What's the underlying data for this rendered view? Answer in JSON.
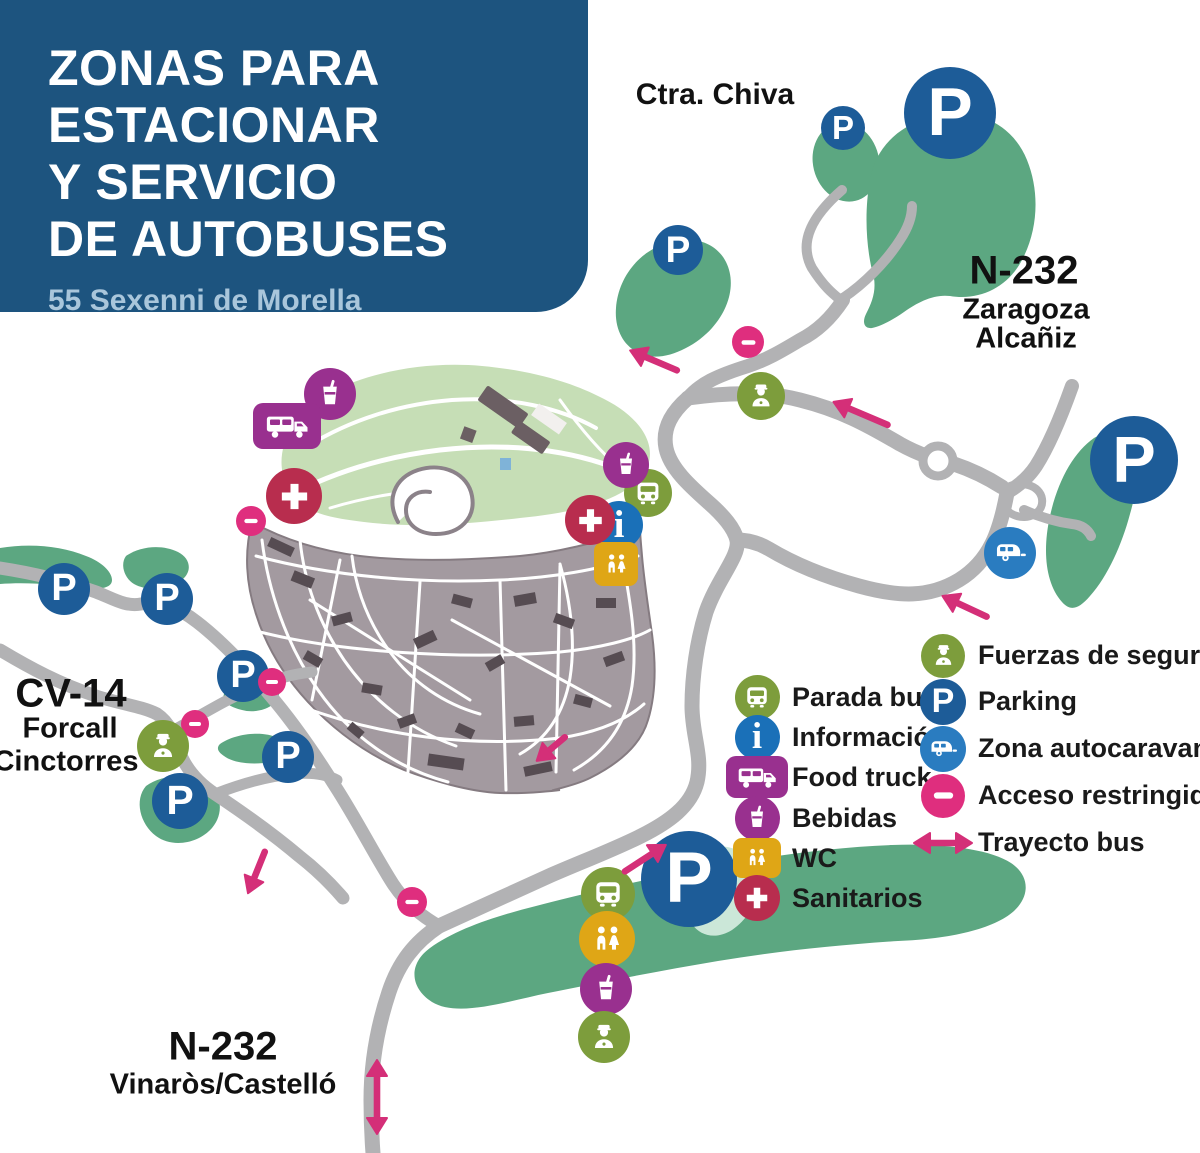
{
  "header": {
    "title_lines": [
      "ZONAS PARA",
      "ESTACIONAR",
      "Y SERVICIO",
      "DE AUTOBUSES"
    ],
    "subtitle": "55 Sexenni de Morella",
    "bg_color": "#1d547f",
    "subtitle_color": "#a9c6db"
  },
  "road_labels": [
    {
      "text": "Ctra. Chiva",
      "x": 715,
      "y": 95,
      "size": 30
    },
    {
      "text": "N-232",
      "x": 1024,
      "y": 271,
      "size": 40
    },
    {
      "text": "Zaragoza",
      "x": 1026,
      "y": 310,
      "size": 29
    },
    {
      "text": "Alcañiz",
      "x": 1026,
      "y": 339,
      "size": 29
    },
    {
      "text": "CV-14",
      "x": 71,
      "y": 694,
      "size": 40
    },
    {
      "text": "Forcall",
      "x": 70,
      "y": 729,
      "size": 29
    },
    {
      "text": "Cinctorres",
      "x": 66,
      "y": 762,
      "size": 29
    },
    {
      "text": "N-232",
      "x": 223,
      "y": 1047,
      "size": 40
    },
    {
      "text": "Vinaròs/Castelló",
      "x": 223,
      "y": 1085,
      "size": 29
    }
  ],
  "legend": {
    "columns": [
      {
        "x": 731,
        "y": 697,
        "row_h": 40.2,
        "items": [
          {
            "icon": "bus",
            "label": "Parada bus",
            "d": 45
          },
          {
            "icon": "info",
            "label": "Información",
            "d": 45
          },
          {
            "icon": "foodtruck",
            "label": "Food truck",
            "w": 62,
            "h": 42
          },
          {
            "icon": "bebidas",
            "label": "Bebidas",
            "d": 45
          },
          {
            "icon": "wc",
            "shape": "square",
            "label": "WC",
            "w": 48,
            "h": 40
          },
          {
            "icon": "sanitarios",
            "label": "Sanitarios",
            "d": 46
          }
        ]
      },
      {
        "x": 917,
        "y": 655,
        "row_h": 46.8,
        "items": [
          {
            "icon": "fuerzas",
            "label": "Fuerzas de seguridad",
            "d": 44
          },
          {
            "icon": "parking",
            "label": "Parking",
            "d": 46
          },
          {
            "icon": "caravan",
            "label": "Zona autocaravanas",
            "d": 46
          },
          {
            "icon": "noentry",
            "label": "Acceso restringido",
            "d": 44
          },
          {
            "icon": "arrow2",
            "label": "Trayecto bus",
            "len": 62
          }
        ]
      }
    ]
  },
  "map": {
    "colors": {
      "bus": "#7d9d3c",
      "fuerzas": "#7d9d3c",
      "info": "#1a70b8",
      "parking": "#1d5c98",
      "caravan": "#2a7cc0",
      "bebidas": "#99308f",
      "foodtruck": "#99308f",
      "wc": "#dfa616",
      "sanitarios": "#b82d4e",
      "noentry": "#df2e7e",
      "arrow": "#d42f78",
      "arrow2": "#d42f78",
      "road": "#b2b2b4",
      "zone_green": "#5ca781",
      "hill_green": "#c6deb6",
      "town_gray": "#a39aa0"
    },
    "markers": [
      {
        "type": "parking",
        "x": 843,
        "y": 128,
        "d": 44
      },
      {
        "type": "parking",
        "x": 678,
        "y": 250,
        "d": 50
      },
      {
        "type": "parking",
        "x": 950,
        "y": 113,
        "d": 92
      },
      {
        "type": "parking",
        "x": 1134,
        "y": 460,
        "d": 88
      },
      {
        "type": "parking",
        "x": 64,
        "y": 589,
        "d": 52
      },
      {
        "type": "parking",
        "x": 167,
        "y": 599,
        "d": 52
      },
      {
        "type": "parking",
        "x": 243,
        "y": 676,
        "d": 52
      },
      {
        "type": "parking",
        "x": 288,
        "y": 757,
        "d": 52
      },
      {
        "type": "parking",
        "x": 180,
        "y": 801,
        "d": 56
      },
      {
        "type": "parking",
        "x": 689,
        "y": 879,
        "d": 96
      },
      {
        "type": "noentry",
        "x": 748,
        "y": 342,
        "d": 32
      },
      {
        "type": "noentry",
        "x": 251,
        "y": 521,
        "d": 30
      },
      {
        "type": "noentry",
        "x": 272,
        "y": 682,
        "d": 28
      },
      {
        "type": "noentry",
        "x": 195,
        "y": 724,
        "d": 28
      },
      {
        "type": "noentry",
        "x": 412,
        "y": 902,
        "d": 30
      },
      {
        "type": "bus",
        "x": 648,
        "y": 493,
        "d": 48
      },
      {
        "type": "bus",
        "x": 608,
        "y": 894,
        "d": 54
      },
      {
        "type": "info",
        "x": 619,
        "y": 525,
        "d": 48
      },
      {
        "type": "wc",
        "shape": "square",
        "x": 616,
        "y": 564,
        "d": 44
      },
      {
        "type": "wc",
        "x": 607,
        "y": 939,
        "d": 56
      },
      {
        "type": "bebidas",
        "x": 330,
        "y": 394,
        "d": 52
      },
      {
        "type": "bebidas",
        "x": 626,
        "y": 465,
        "d": 46
      },
      {
        "type": "bebidas",
        "x": 606,
        "y": 989,
        "d": 52
      },
      {
        "type": "foodtruck",
        "x": 287,
        "y": 426,
        "w": 68,
        "h": 46
      },
      {
        "type": "sanitarios",
        "x": 294,
        "y": 496,
        "d": 56
      },
      {
        "type": "sanitarios",
        "x": 590,
        "y": 520,
        "d": 50
      },
      {
        "type": "fuerzas",
        "x": 761,
        "y": 396,
        "d": 48
      },
      {
        "type": "fuerzas",
        "x": 163,
        "y": 746,
        "d": 52
      },
      {
        "type": "fuerzas",
        "x": 604,
        "y": 1037,
        "d": 52
      },
      {
        "type": "caravan",
        "x": 1010,
        "y": 553,
        "d": 52
      },
      {
        "type": "arrow",
        "x": 862,
        "y": 414,
        "len": 66,
        "rot": 203
      },
      {
        "type": "arrow",
        "x": 966,
        "y": 607,
        "len": 56,
        "rot": 205
      },
      {
        "type": "arrow",
        "x": 644,
        "y": 859,
        "len": 56,
        "rot": -33
      },
      {
        "type": "arrow",
        "x": 655,
        "y": 361,
        "len": 58,
        "rot": 203
      },
      {
        "type": "arrow",
        "x": 552,
        "y": 748,
        "len": 44,
        "rot": 140
      },
      {
        "type": "arrow",
        "x": 257,
        "y": 871,
        "len": 52,
        "rot": 112
      },
      {
        "type": "arrow2",
        "x": 377,
        "y": 1097,
        "len": 78,
        "rot": 90
      }
    ]
  }
}
